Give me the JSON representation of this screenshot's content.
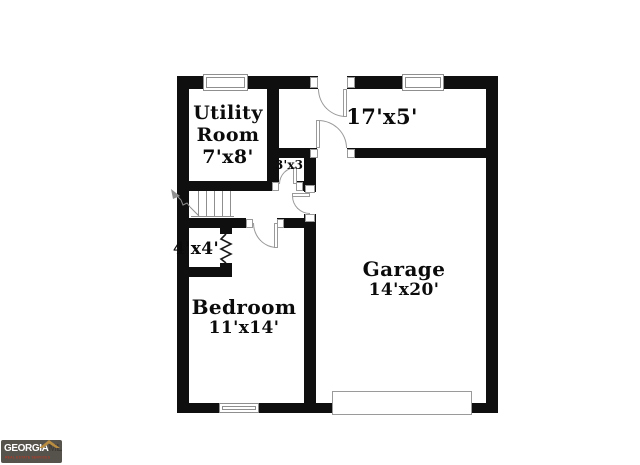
{
  "rooms": {
    "utility": {
      "name_line1": "Utility",
      "name_line2": "Room",
      "dims": "7'x8'"
    },
    "hall": {
      "dims": "17'x5'"
    },
    "closet_small": {
      "dims": "3'x3'"
    },
    "closet": {
      "dims": "4'x4'"
    },
    "bedroom": {
      "name": "Bedroom",
      "dims": "11'x14'"
    },
    "garage": {
      "name": "Garage",
      "dims": "14'x20'"
    }
  },
  "logo": {
    "brand": "GEORGIA",
    "suffix": "MLS",
    "tagline": "REAL ESTATE SERVICES"
  },
  "colors": {
    "wall": "#0f0f0f",
    "thin_line": "#8f8f8f",
    "logo_bg": "#56524c",
    "logo_brand": "#ffffff",
    "logo_suffix": "#403c37",
    "logo_roof": "#b98d41",
    "logo_tagline": "#ab3d2a"
  }
}
